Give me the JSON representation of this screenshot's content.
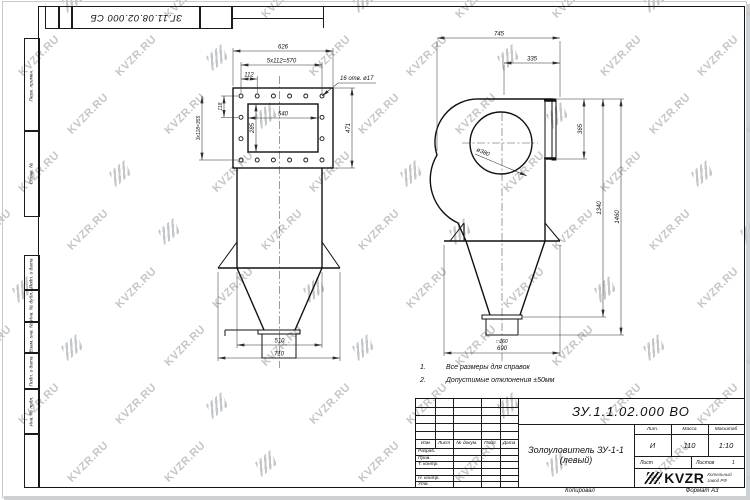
{
  "page": {
    "corner_stamp": "ЗГ.11.08.02.000 СБ",
    "copied": "Копировал",
    "format": "Формат А3"
  },
  "watermark": {
    "text": "KVZR.RU"
  },
  "side_labels": {
    "perv": "Перв. примен.",
    "sprav": "Справ. №",
    "podp1": "Подп. и дата",
    "inv_dubl": "Инв. № дубл.",
    "vzam": "Взам. инв. №",
    "podp2": "Подп. и дата",
    "inv_podl": "Инв. № подл."
  },
  "notes": {
    "n1_num": "1.",
    "n1_text": "Все размеры для справок",
    "n2_num": "2.",
    "n2_text": "Допустимые отклонения ±50мм"
  },
  "title_block": {
    "doc_number": "ЗУ.1.1.02.000 ВО",
    "name_line1": "Золоуловитель ЗУ-1-1",
    "name_line2": "(левый)",
    "col_izm": "Изм",
    "col_list": "Лист",
    "col_doc": "№ докум.",
    "col_podp": "Подп.",
    "col_data": "Дата",
    "row_razrab": "Разраб.",
    "row_prov": "Пров.",
    "row_tkontr": "Т. контр.",
    "row_nkontr": "Н. контр.",
    "row_utv": "Утв.",
    "lit_label": "Лит.",
    "mass_label": "Масса",
    "scale_label": "Масштаб",
    "lit_value": "И",
    "mass_value": "110",
    "scale_value": "1:10",
    "sheet_label": "Лист",
    "sheets_label": "Листов",
    "sheets_value": "1",
    "logo_text": "KVZR",
    "logo_sub1": "Котельный",
    "logo_sub2": "завод РФ"
  },
  "front_view": {
    "dims": {
      "d626": "626",
      "d570": "5x112=570",
      "d112": "112",
      "holes": "16 отв. ø17",
      "d540": "540",
      "d285": "285",
      "d471": "471",
      "d118": "118",
      "d355": "3x118=355",
      "d510": "510",
      "d710": "710"
    }
  },
  "side_view": {
    "dims": {
      "d745": "745",
      "d335": "335",
      "d365": "365",
      "d1340": "1340",
      "d1460": "1460",
      "d690": "690",
      "d380": "ø380",
      "outlet": "□160"
    }
  }
}
